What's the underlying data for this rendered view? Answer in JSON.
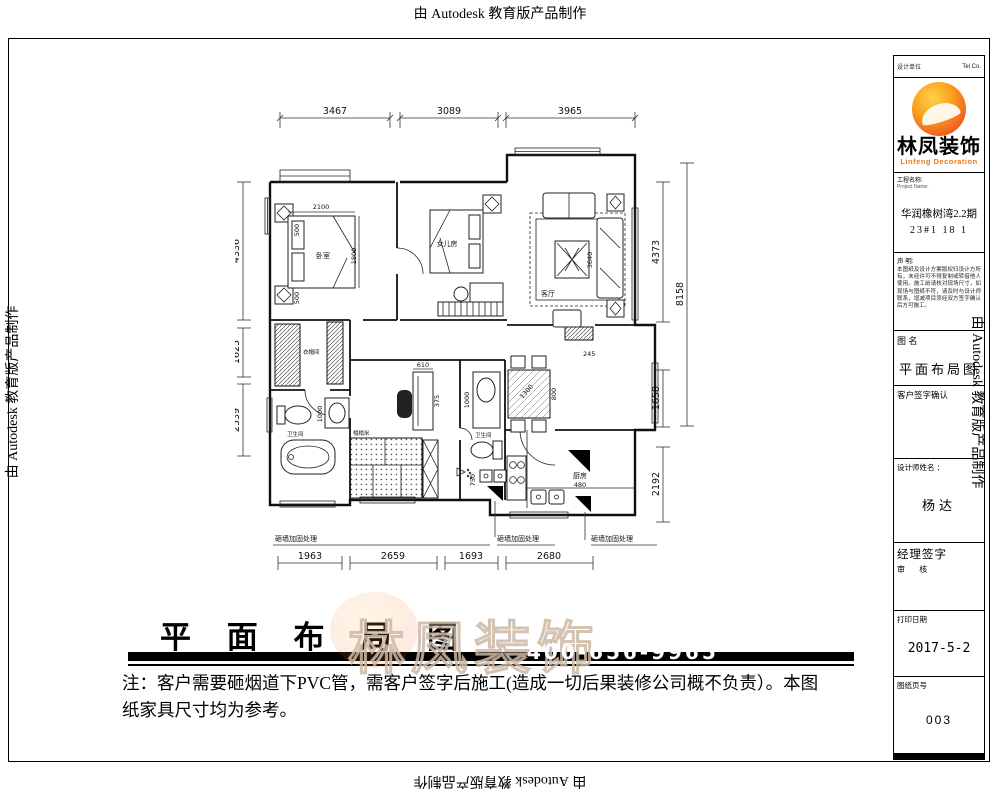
{
  "frame": {
    "top_text": "由 Autodesk 教育版产品制作",
    "bottom_text": "由 Autodesk 教育版产品制作",
    "left_text": "由 Autodesk 教育版产品制作",
    "right_text": "由 Autodesk 教育版产品制作"
  },
  "title_block": {
    "header_left": "设计单位",
    "header_right": "Tel  Co.",
    "logo_cn": "林凤装饰",
    "logo_en": "Linfeng Decoration",
    "project_label": "工程名称:",
    "project_sublabel": "Project Name:",
    "project_line1": "华润橡树湾2.2期",
    "project_line2": "23#1 18 1",
    "statement_label": "声  明:",
    "statement_text": "本图纸及设计方案版权归设计方所有，未经许可不得复制或转借他人使用。施工前请核对现场尺寸，如现场与图纸不符，请及时与设计师联系，增减项目须经双方签字确认后方可施工。",
    "drawing_name_label": "图  名",
    "drawing_name_value": "平面布局图",
    "client_sign_label": "客户签字确认",
    "designer_label": "设计师姓名 ：",
    "designer_value": "杨达",
    "manager_label": "经理签字",
    "manager_sublabel": "审    核",
    "date_label": "打印日期",
    "date_value": "2017-5-2",
    "page_label": "图纸页号",
    "page_value": "003"
  },
  "plan": {
    "dims_top": [
      "3467",
      "3089",
      "3965"
    ],
    "dims_left": [
      "4336",
      "1625",
      "2539"
    ],
    "dims_right": [
      "4373",
      "1658",
      "2192"
    ],
    "dim_right_outer": "8158",
    "dims_bottom": [
      "1963",
      "2659",
      "1693",
      "2680"
    ],
    "inner_dims": {
      "bed_w": "2100",
      "bed_d": "1800",
      "n_top": "500",
      "n_bot": "500",
      "sofa": "3640",
      "cab_w": "610",
      "cab_d": "375",
      "basin1": "1000",
      "basin2": "1000",
      "shower": "750",
      "table_w": "1300",
      "table_d": "800",
      "col": "245",
      "kitchen": "480"
    },
    "rooms": {
      "master": "卧室",
      "kids": "女儿房",
      "living": "客厅",
      "cloak": "衣帽间",
      "bath1": "卫生间",
      "bath2": "卫生间",
      "tatami": "榻榻米",
      "kitchen": "厨房"
    },
    "note_reinforce_1": "砸墙加固处理",
    "note_reinforce_2": "砸墙加固处理",
    "note_reinforce_3": "砸墙加固处理"
  },
  "footer": {
    "title": "平 面 布 局 图",
    "note_line1": "注：客户需要砸烟道下PVC管，需客户签字后施工(造成一切后果装修公司概不负责）。本图",
    "note_line2": "纸家具尺寸均为参考。"
  },
  "watermark": {
    "brand": "林凤装饰",
    "phone": "400-656-9965"
  }
}
